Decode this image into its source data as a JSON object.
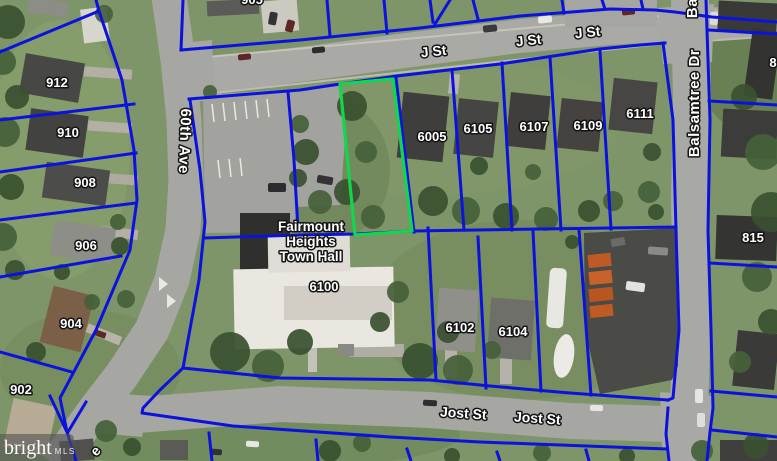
{
  "map": {
    "streets": {
      "j_st": "J St",
      "sixtieth_ave": "60th Ave",
      "balsamtree_dr": "Balsamtree Dr",
      "jost_st": "Jost St",
      "partial_street_letter": "e"
    },
    "parcels": {
      "n905_partial": "905",
      "n912": "912",
      "n910": "910",
      "n908": "908",
      "n906": "906",
      "n904": "904",
      "n902": "902",
      "n6005": "6005",
      "n6105": "6105",
      "n6107": "6107",
      "n6109": "6109",
      "n6111": "6111",
      "n815": "815",
      "n8_partial": "8",
      "n6100": "6100",
      "n6102": "6102",
      "n6104": "6104"
    },
    "poi": {
      "town_hall_line1": "Fairmount",
      "town_hall_line2": "Heights",
      "town_hall_line3": "Town Hall"
    },
    "watermark": {
      "brand": "bright",
      "suffix": "MLS"
    },
    "colors": {
      "parcel_line": "#0c12dd",
      "highlight_line": "#12d64e",
      "label_fill": "#ffffff",
      "label_halo": "#141414"
    }
  }
}
